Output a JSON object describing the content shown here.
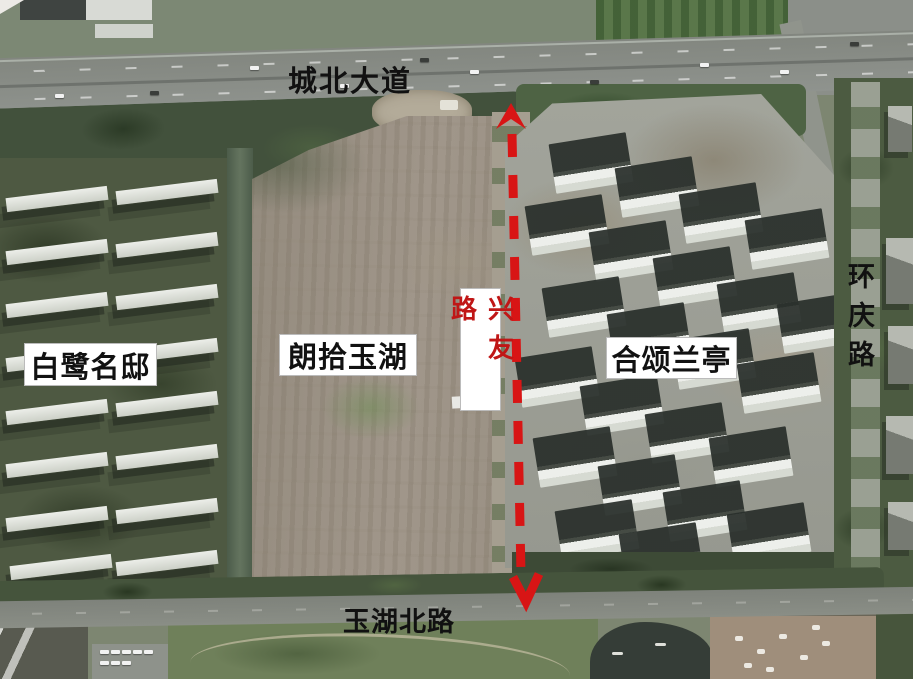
{
  "labels": {
    "chengbei_avenue": "城北大道",
    "bailu_mingdi": "白鹭名邸",
    "langshi_yuhu": "朗拾玉湖",
    "xingyou_road": "兴友路",
    "hesong_lanting": "合颂兰亭",
    "huanqing_road": "环庆路",
    "yuhu_north_road": "玉湖北路"
  },
  "colors": {
    "route_red": "#d81515",
    "xingyou_text_red": "#c01616",
    "label_text_black": "#111111",
    "label_box_white": "#ffffff"
  }
}
